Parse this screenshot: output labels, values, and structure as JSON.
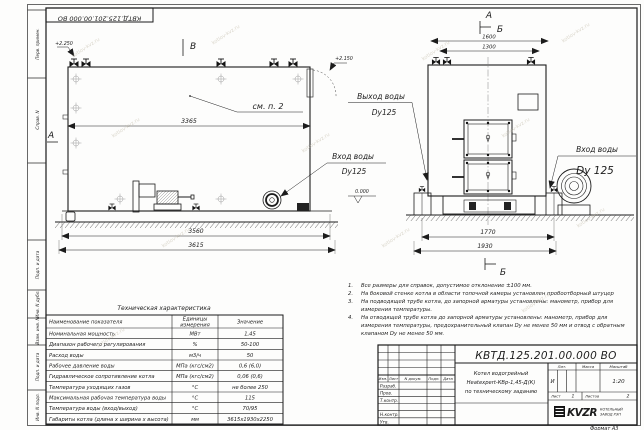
{
  "doc": {
    "stamp_top": "КВТД.125.201.00.000  ВО",
    "number": "КВТД.125.201.00.000  ВО"
  },
  "watermark": "kotlov-kvz.ru",
  "margin_labels": [
    "Перв. примен.",
    "Справ. N",
    "Подп. и дата",
    "Инв. N дубл.",
    "Взам. инв. N",
    "Подп. и дата",
    "Инв. N подл."
  ],
  "side_view": {
    "view_label": "В",
    "section_label": "А",
    "elevation_top": "+2.250",
    "elevation_zero": "0.000",
    "see_note": "см. п. 2",
    "dim_body": "3365",
    "dim_frame": "3560",
    "dim_overall": "3615",
    "inlet_title": "Вход воды",
    "inlet_dn": "Dy125"
  },
  "front_view": {
    "section_a": "А",
    "section_b": "Б",
    "section_b_bottom": "Б",
    "elevation": "+2.150",
    "dim_top_outer": "1600",
    "dim_top_inner": "1300",
    "dim_supports": "1770",
    "dim_base": "1930",
    "outlet_title": "Выход воды",
    "outlet_dn": "Dy125",
    "inlet_title": "Вход воды",
    "inlet_dn": "Dy 125"
  },
  "notes": [
    {
      "n": "1.",
      "t": "Все размеры для справок, допустимое отклонение ±100 мм."
    },
    {
      "n": "2.",
      "t": "На боковой стенке котла в области топочной камеры установлен пробоотборный штуцер"
    },
    {
      "n": "3.",
      "t": "На подводящей трубе котла, до запорной арматуры установлены: манометр, прибор для измерения температуры."
    },
    {
      "n": "4.",
      "t": "На отводящей трубе котла до запорной арматуры установлены: манометр, прибор для измерения температуры, предохранительный клапан Dу не менее 50 мм и отвод с обратным клапаном Dу не менее 50 мм."
    }
  ],
  "tech": {
    "title": "Техническая характеристика",
    "h_name": "Наименование показателя",
    "h_unit1": "Единицы",
    "h_unit2": "измерения",
    "h_value": "Значение",
    "rows": [
      [
        "Номинальная мощность",
        "МВт",
        "1,45"
      ],
      [
        "Диапазон рабочего регулирования",
        "%",
        "50-100"
      ],
      [
        "Расход воды",
        "м3/ч",
        "50"
      ],
      [
        "Рабочее давление воды",
        "МПа (кгс/см2)",
        "0,6 (6,0)"
      ],
      [
        "Гидравлическое сопротивление котла",
        "МПа (кгс/см2)",
        "0,06 (0,6)"
      ],
      [
        "Температура уходящих газов",
        "°С",
        "не более 250"
      ],
      [
        "Максимальная рабочая температура воды",
        "°С",
        "115"
      ],
      [
        "Температура воды (вход/выход)",
        "°С",
        "70/95"
      ],
      [
        "Габариты котла (длина х ширина х высота)",
        "мм",
        "3615х1930х2250"
      ]
    ]
  },
  "title_block": {
    "desc1": "Котел водогрейный",
    "desc2": "Heatexpert-КВр-1,45-Д(К)",
    "desc3": "по техническому заданию",
    "col_izm": "Изм.",
    "col_list": "Лист",
    "col_doc": "N докум.",
    "col_podp": "Подп.",
    "col_data": "Дата",
    "row_razrab": "Разраб.",
    "row_prov": "Пров.",
    "row_tkontr": "Т.контр.",
    "row_nkontr": "Н.контр.",
    "row_utv": "Утв.",
    "lit_h": "Лит.",
    "mass_h": "Масса",
    "scale_h": "Масштаб",
    "lit": "И",
    "scale": "1:20",
    "sheet_h": "Лист",
    "sheet": "1",
    "sheets_h": "Листов",
    "sheets": "2",
    "logo": "KVZR",
    "company1": "КОТЕЛЬНЫЙ",
    "company2": "ЗАВОД РЭП",
    "format": "Формат  А3"
  }
}
